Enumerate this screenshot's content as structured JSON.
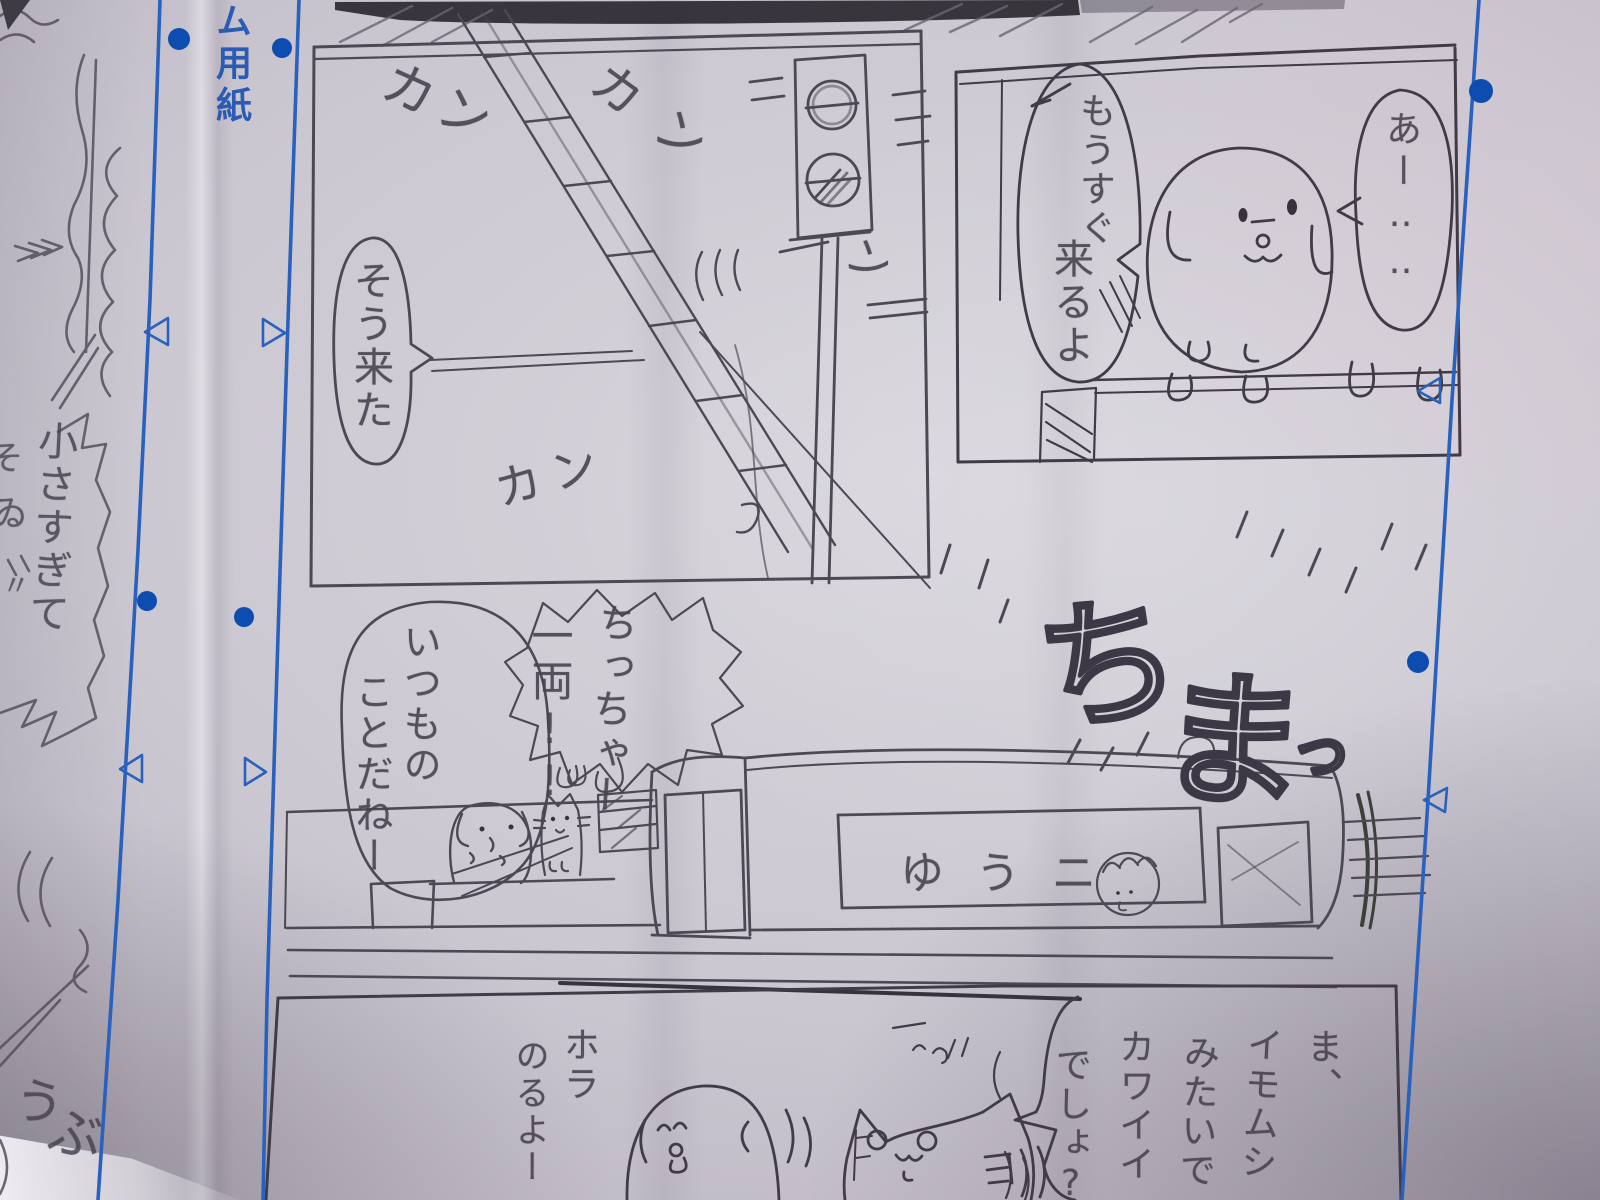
{
  "photo": {
    "colors": {
      "paper": "#cbc7d1",
      "pencil": "#4e4854",
      "pencil_dark": "#37323e",
      "blue_line": "#2a61bd",
      "blue_mark": "#0d4db0",
      "top_band": "#2b2830"
    }
  },
  "manuscript": {
    "margin_label": "ム用紙"
  },
  "left_page": {
    "bubble_text": "小さすぎて",
    "fragment_so": "そ",
    "fragment_ru": "ゐ",
    "fragment_dakuten": "〃",
    "sfx_u": "う",
    "sfx_bu": "ぶ"
  },
  "panel_crossing": {
    "sfx_kan_1": "カン",
    "sfx_kan_2": "カン",
    "sfx_n": "ン",
    "sfx_kan_3": "カン",
    "bubble_here_it_comes": "そう来た"
  },
  "panel_dog": {
    "bubble_coming_soon_1": "もうすぐ",
    "bubble_coming_soon_2": "来るよ",
    "bubble_ah": "あー‥‥"
  },
  "scene_train": {
    "bubble_usual_1": "いつもの",
    "bubble_usual_2": "ことだねー",
    "shout_tiny": "ちっちゃー",
    "shout_one_car": "一両!!",
    "sfx_chi": "ち",
    "sfx_ma": "ま",
    "sfx_small_tsu": "っ",
    "train_side_text": "ゆうニ"
  },
  "panel_boarding": {
    "text_hora": "ホラ",
    "text_noruyo": "のるよー",
    "bubble_lines": [
      "ま、",
      "イモムシ",
      "みたいで",
      "カワイイ",
      "でしょ?"
    ]
  }
}
